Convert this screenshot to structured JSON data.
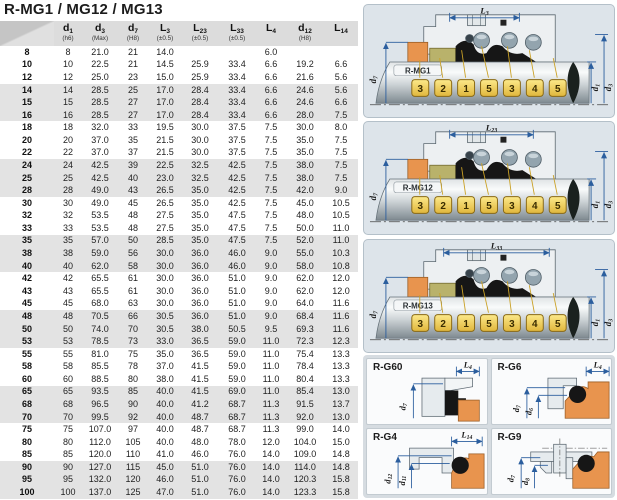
{
  "title": "R-MG1 / MG12 / MG13",
  "table": {
    "headers": [
      {
        "base": "",
        "sub": "",
        "tol": ""
      },
      {
        "base": "d",
        "sub": "1",
        "tol": "(h6)"
      },
      {
        "base": "d",
        "sub": "3",
        "tol": "(Max)"
      },
      {
        "base": "d",
        "sub": "7",
        "tol": "(H8)"
      },
      {
        "base": "L",
        "sub": "3",
        "tol": "(±0.5)"
      },
      {
        "base": "L",
        "sub": "23",
        "tol": "(±0.5)"
      },
      {
        "base": "L",
        "sub": "33",
        "tol": "(±0.5)"
      },
      {
        "base": "L",
        "sub": "4",
        "tol": ""
      },
      {
        "base": "d",
        "sub": "12",
        "tol": "(H8)"
      },
      {
        "base": "L",
        "sub": "14",
        "tol": ""
      }
    ],
    "rows": [
      [
        "8",
        "8",
        "21.0",
        "21",
        "14.0",
        "",
        "",
        "6.0",
        "",
        ""
      ],
      [
        "10",
        "10",
        "22.5",
        "21",
        "14.5",
        "25.9",
        "33.4",
        "6.6",
        "19.2",
        "6.6"
      ],
      [
        "12",
        "12",
        "25.0",
        "23",
        "15.0",
        "25.9",
        "33.4",
        "6.6",
        "21.6",
        "5.6"
      ],
      [
        "14",
        "14",
        "28.5",
        "25",
        "17.0",
        "28.4",
        "33.4",
        "6.6",
        "24.6",
        "5.6"
      ],
      [
        "15",
        "15",
        "28.5",
        "27",
        "17.0",
        "28.4",
        "33.4",
        "6.6",
        "24.6",
        "6.6"
      ],
      [
        "16",
        "16",
        "28.5",
        "27",
        "17.0",
        "28.4",
        "33.4",
        "6.6",
        "28.0",
        "7.5"
      ],
      [
        "18",
        "18",
        "32.0",
        "33",
        "19.5",
        "30.0",
        "37.5",
        "7.5",
        "30.0",
        "8.0"
      ],
      [
        "20",
        "20",
        "37.0",
        "35",
        "21.5",
        "30.0",
        "37.5",
        "7.5",
        "35.0",
        "7.5"
      ],
      [
        "22",
        "22",
        "37.0",
        "37",
        "21.5",
        "30.0",
        "37.5",
        "7.5",
        "35.0",
        "7.5"
      ],
      [
        "24",
        "24",
        "42.5",
        "39",
        "22.5",
        "32.5",
        "42.5",
        "7.5",
        "38.0",
        "7.5"
      ],
      [
        "25",
        "25",
        "42.5",
        "40",
        "23.0",
        "32.5",
        "42.5",
        "7.5",
        "38.0",
        "7.5"
      ],
      [
        "28",
        "28",
        "49.0",
        "43",
        "26.5",
        "35.0",
        "42.5",
        "7.5",
        "42.0",
        "9.0"
      ],
      [
        "30",
        "30",
        "49.0",
        "45",
        "26.5",
        "35.0",
        "42.5",
        "7.5",
        "45.0",
        "10.5"
      ],
      [
        "32",
        "32",
        "53.5",
        "48",
        "27.5",
        "35.0",
        "47.5",
        "7.5",
        "48.0",
        "10.5"
      ],
      [
        "33",
        "33",
        "53.5",
        "48",
        "27.5",
        "35.0",
        "47.5",
        "7.5",
        "50.0",
        "11.0"
      ],
      [
        "35",
        "35",
        "57.0",
        "50",
        "28.5",
        "35.0",
        "47.5",
        "7.5",
        "52.0",
        "11.0"
      ],
      [
        "38",
        "38",
        "59.0",
        "56",
        "30.0",
        "36.0",
        "46.0",
        "9.0",
        "55.0",
        "10.3"
      ],
      [
        "40",
        "40",
        "62.0",
        "58",
        "30.0",
        "36.0",
        "46.0",
        "9.0",
        "58.0",
        "10.8"
      ],
      [
        "42",
        "42",
        "65.5",
        "61",
        "30.0",
        "36.0",
        "51.0",
        "9.0",
        "62.0",
        "12.0"
      ],
      [
        "43",
        "43",
        "65.5",
        "61",
        "30.0",
        "36.0",
        "51.0",
        "9.0",
        "62.0",
        "12.0"
      ],
      [
        "45",
        "45",
        "68.0",
        "63",
        "30.0",
        "36.0",
        "51.0",
        "9.0",
        "64.0",
        "11.6"
      ],
      [
        "48",
        "48",
        "70.5",
        "66",
        "30.5",
        "36.0",
        "51.0",
        "9.0",
        "68.4",
        "11.6"
      ],
      [
        "50",
        "50",
        "74.0",
        "70",
        "30.5",
        "38.0",
        "50.5",
        "9.5",
        "69.3",
        "11.6"
      ],
      [
        "53",
        "53",
        "78.5",
        "73",
        "33.0",
        "36.5",
        "59.0",
        "11.0",
        "72.3",
        "12.3"
      ],
      [
        "55",
        "55",
        "81.0",
        "75",
        "35.0",
        "36.5",
        "59.0",
        "11.0",
        "75.4",
        "13.3"
      ],
      [
        "58",
        "58",
        "85.5",
        "78",
        "37.0",
        "41.5",
        "59.0",
        "11.0",
        "78.4",
        "13.3"
      ],
      [
        "60",
        "60",
        "88.5",
        "80",
        "38.0",
        "41.5",
        "59.0",
        "11.0",
        "80.4",
        "13.3"
      ],
      [
        "65",
        "65",
        "93.5",
        "85",
        "40.0",
        "41.5",
        "69.0",
        "11.0",
        "85.4",
        "13.0"
      ],
      [
        "68",
        "68",
        "96.5",
        "90",
        "40.0",
        "41.2",
        "68.7",
        "11.3",
        "91.5",
        "13.7"
      ],
      [
        "70",
        "70",
        "99.5",
        "92",
        "40.0",
        "48.7",
        "68.7",
        "11.3",
        "92.0",
        "13.0"
      ],
      [
        "75",
        "75",
        "107.0",
        "97",
        "40.0",
        "48.7",
        "68.7",
        "11.3",
        "99.0",
        "14.0"
      ],
      [
        "80",
        "80",
        "112.0",
        "105",
        "40.0",
        "48.0",
        "78.0",
        "12.0",
        "104.0",
        "15.0"
      ],
      [
        "85",
        "85",
        "120.0",
        "110",
        "41.0",
        "46.0",
        "76.0",
        "14.0",
        "109.0",
        "14.8"
      ],
      [
        "90",
        "90",
        "127.0",
        "115",
        "45.0",
        "51.0",
        "76.0",
        "14.0",
        "114.0",
        "14.8"
      ],
      [
        "95",
        "95",
        "132.0",
        "120",
        "46.0",
        "51.0",
        "76.0",
        "14.0",
        "120.3",
        "15.8"
      ],
      [
        "100",
        "100",
        "137.0",
        "125",
        "47.0",
        "51.0",
        "76.0",
        "14.0",
        "123.3",
        "15.8"
      ]
    ]
  },
  "diagrams": [
    {
      "name": "R-MG1",
      "top_base": "L",
      "top_sub": "3",
      "left_base": "d",
      "left_sub": "7",
      "r1_base": "d",
      "r1_sub": "1",
      "r2_base": "d",
      "r2_sub": "3",
      "callouts": [
        "3",
        "2",
        "1",
        "5",
        "3",
        "4",
        "5"
      ]
    },
    {
      "name": "R-MG12",
      "top_base": "L",
      "top_sub": "23",
      "left_base": "d",
      "left_sub": "7",
      "r1_base": "d",
      "r1_sub": "1",
      "r2_base": "d",
      "r2_sub": "3",
      "callouts": [
        "3",
        "2",
        "1",
        "5",
        "3",
        "4",
        "5"
      ]
    },
    {
      "name": "R-MG13",
      "top_base": "L",
      "top_sub": "33",
      "left_base": "d",
      "left_sub": "7",
      "r1_base": "d",
      "r1_sub": "1",
      "r2_base": "d",
      "r2_sub": "3",
      "callouts": [
        "3",
        "2",
        "1",
        "5",
        "3",
        "4",
        "5"
      ]
    }
  ],
  "seats": [
    {
      "name": "R-G60",
      "top_base": "L",
      "top_sub": "4",
      "dims": [
        {
          "base": "d",
          "sub": "7"
        }
      ]
    },
    {
      "name": "R-G6",
      "top_base": "L",
      "top_sub": "4",
      "dims": [
        {
          "base": "d",
          "sub": "7"
        },
        {
          "base": "d",
          "sub": "6"
        }
      ]
    },
    {
      "name": "R-G4",
      "top_base": "L",
      "top_sub": "14",
      "dims": [
        {
          "base": "d",
          "sub": "12"
        },
        {
          "base": "d",
          "sub": "11"
        }
      ]
    },
    {
      "name": "R-G9",
      "dims": [
        {
          "base": "d",
          "sub": "7"
        },
        {
          "base": "d",
          "sub": "8"
        }
      ]
    }
  ],
  "colors": {
    "accent_blue": "#2b5e9e",
    "callout_yellow": "#f2cf4e",
    "seat_orange": "#e8944e",
    "panel_bg": "#dde4ea",
    "stripe_gray": "#e3e3e3",
    "header_gray": "#dcdcdc"
  }
}
